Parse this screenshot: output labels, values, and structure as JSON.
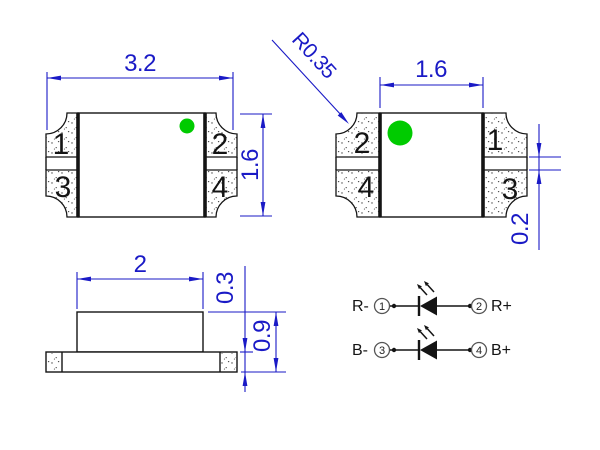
{
  "colors": {
    "dimension_blue": "#1a1ac6",
    "line_black": "#141414",
    "marker_green": "#00cb00"
  },
  "top_view": {
    "width_dim": "3.2",
    "height_dim": "1.6",
    "pad_numbers": [
      "1",
      "2",
      "3",
      "4"
    ]
  },
  "bottom_view": {
    "inner_width_dim": "1.6",
    "corner_radius_dim": "R0.35",
    "pad_gap_dim": "0.2",
    "pad_numbers": [
      "2",
      "1",
      "4",
      "3"
    ]
  },
  "side_view": {
    "top_width_dim": "2",
    "base_thickness_dim": "0.3",
    "height_dim": "0.9"
  },
  "circuit": {
    "rows": [
      {
        "neg_label": "R-",
        "neg_pin": "1",
        "pos_pin": "2",
        "pos_label": "R+"
      },
      {
        "neg_label": "B-",
        "neg_pin": "3",
        "pos_pin": "4",
        "pos_label": "B+"
      }
    ]
  }
}
